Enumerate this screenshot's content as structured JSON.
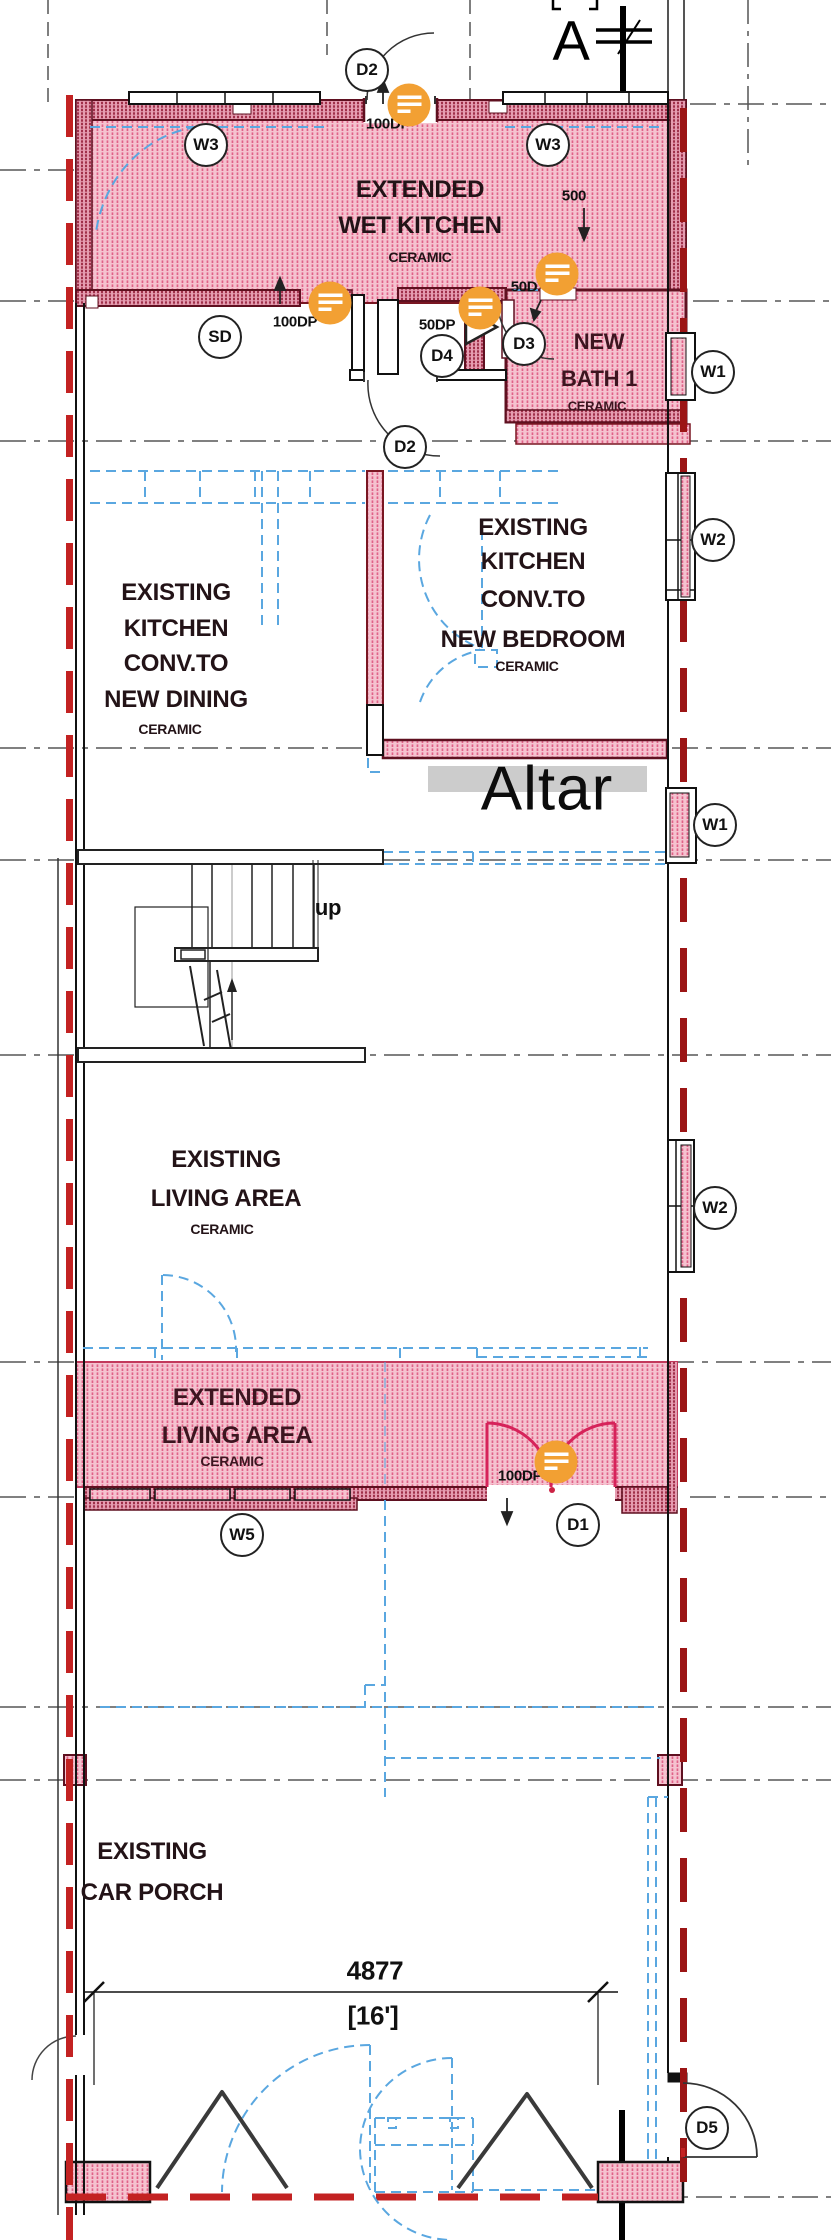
{
  "plan": {
    "rooms": [
      {
        "lines": [
          "EXTENDED",
          "WET KITCHEN"
        ],
        "material": "CERAMIC"
      },
      {
        "lines": [
          "NEW",
          "BATH 1"
        ],
        "material": "CERAMIC"
      },
      {
        "lines": [
          "EXISTING",
          "KITCHEN",
          "CONV.TO",
          "NEW DINING"
        ],
        "material": "CERAMIC"
      },
      {
        "lines": [
          "EXISTING",
          "KITCHEN",
          "CONV.TO",
          "NEW BEDROOM"
        ],
        "material": "CERAMIC"
      },
      {
        "lines": [
          "EXISTING",
          "LIVING AREA"
        ],
        "material": "CERAMIC"
      },
      {
        "lines": [
          "EXTENDED",
          "LIVING AREA"
        ],
        "material": "CERAMIC"
      },
      {
        "lines": [
          "EXISTING",
          "CAR PORCH"
        ],
        "material": ""
      }
    ],
    "tags": [
      "D2",
      "W3",
      "W3",
      "SD",
      "D4",
      "D3",
      "D2",
      "W1",
      "W2",
      "W1",
      "W2",
      "W5",
      "D1",
      "D5"
    ],
    "openings": [
      "100DP",
      "100DP",
      "50DP",
      "50D",
      "500",
      "100DP"
    ],
    "dimension": {
      "mm": "4877",
      "ft": "[16']"
    },
    "annotations": {
      "altar": "Altar",
      "up": "up",
      "section": "A",
      "section_top": "[ ]"
    },
    "markers": [
      "comment-pin",
      "comment-pin",
      "comment-pin",
      "comment-pin",
      "comment-pin"
    ],
    "colors": {
      "hatch_pink": "#f5c2cf",
      "hatch_stripe": "#e06288",
      "wall_dark": "#5f1020",
      "demolish_red": "#c32222",
      "renovation_red": "#9b1515",
      "blue_dashed": "#5aa7e0",
      "grid_gray": "#808080",
      "highlight_gray": "#cccccc",
      "marker_orange": "#f2a033",
      "door_red": "#d6235a"
    }
  }
}
